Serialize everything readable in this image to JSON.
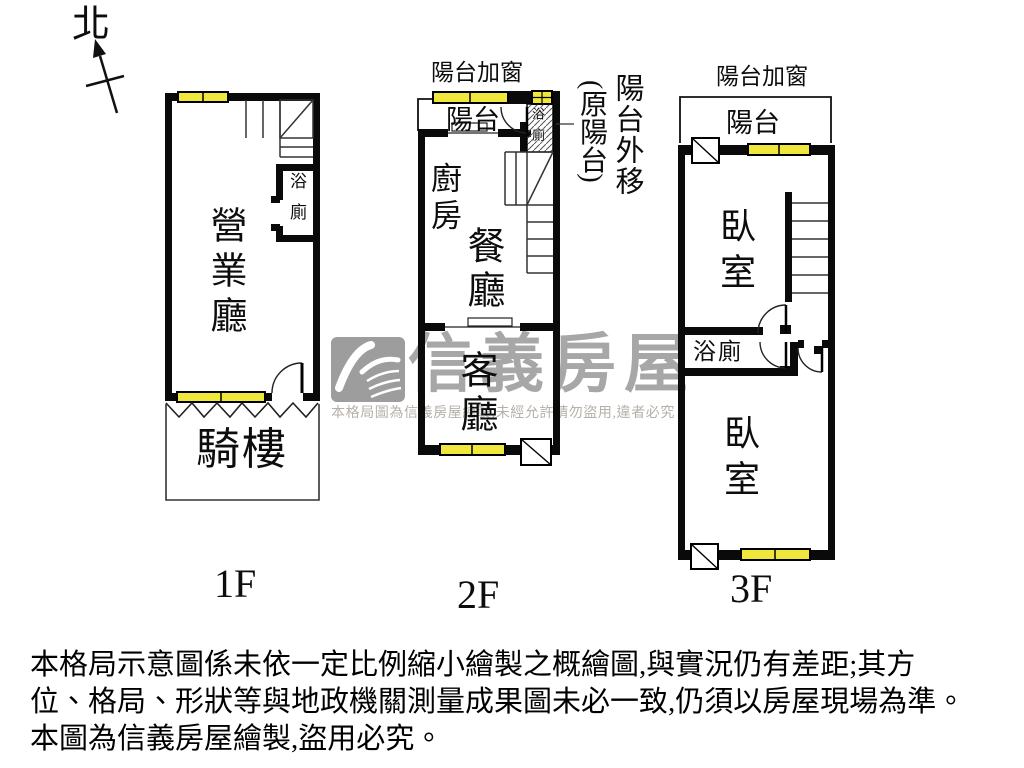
{
  "colors": {
    "wall_black": "#0a0a0a",
    "window_yellow": "#f0e73c",
    "thin_line": "#222222",
    "watermark_gray": "#a7a7a7",
    "watermark_notice_gray": "#b6b0a9"
  },
  "compass": {
    "north_label": "北"
  },
  "floor_1f": {
    "floor_label": "1F",
    "room_main": "營業廳",
    "room_bath": "浴廁",
    "room_arcade": "騎樓"
  },
  "floor_2f": {
    "floor_label": "2F",
    "balcony_window_note": "陽台加窗",
    "room_balcony": "陽台",
    "room_bath": "浴廁",
    "room_kitchen": "廚房",
    "room_dining": "餐廳",
    "room_living": "客廳",
    "annotation_balcony_moved": "陽台外移",
    "annotation_balcony_moved_sub": "(原陽台)"
  },
  "floor_3f": {
    "floor_label": "3F",
    "balcony_window_note": "陽台加窗",
    "room_balcony": "陽台",
    "room_bedroom_front": "臥室",
    "room_bath": "浴廁",
    "room_bedroom_back": "臥室"
  },
  "watermark": {
    "brand": "信義房屋",
    "notice": "本格局圖為信義房屋繪製,未經允許請勿盜用,違者必究"
  },
  "disclaimer": {
    "line1": "本格局示意圖係未依一定比例縮小繪製之概繪圖,與實況仍有差距;其方",
    "line2": "位、格局、形狀等與地政機關測量成果圖未必一致,仍須以房屋現場為準。",
    "line3": "本圖為信義房屋繪製,盜用必究。"
  }
}
